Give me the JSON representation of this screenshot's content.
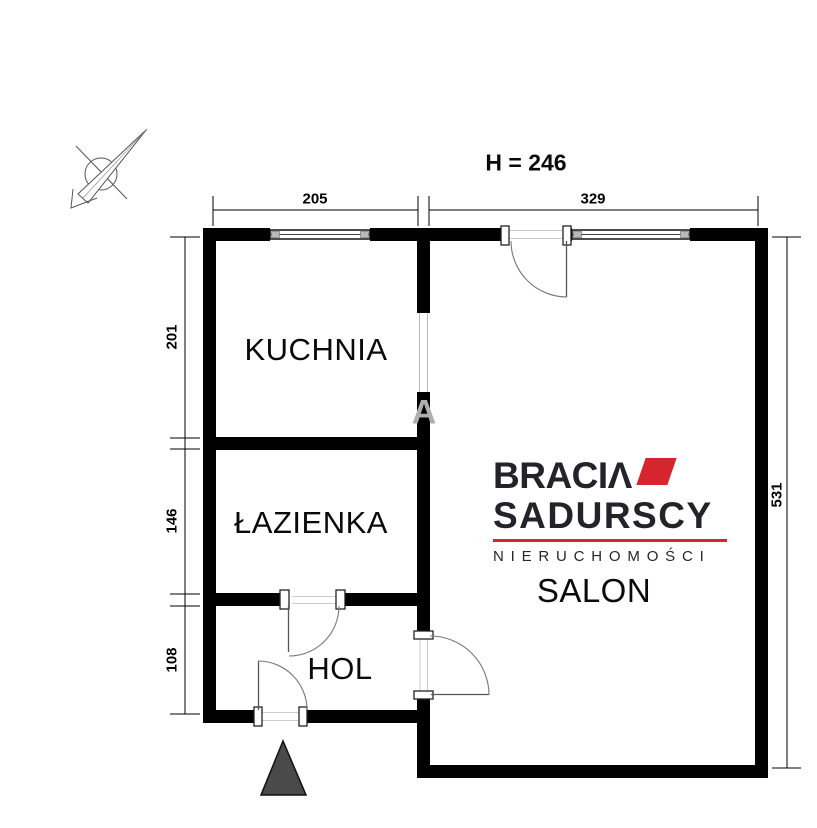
{
  "header": {
    "ceiling_height": "H = 246"
  },
  "dimensions": {
    "top": [
      {
        "label": "205"
      },
      {
        "label": "329"
      }
    ],
    "left": [
      {
        "label": "201"
      },
      {
        "label": "146"
      },
      {
        "label": "108"
      }
    ],
    "right": [
      {
        "label": "531"
      }
    ]
  },
  "rooms": {
    "kitchen": {
      "label": "KUCHNIA"
    },
    "bathroom": {
      "label": "ŁAZIENKA"
    },
    "hall": {
      "label": "HOL"
    },
    "living_room": {
      "label": "SALON"
    }
  },
  "watermark_letter": "A",
  "logo": {
    "line1_main": "BRACI",
    "line1_last": "Λ",
    "line2": "SADURSCY",
    "line3": "NIERUCHOMOŚCI"
  },
  "colors": {
    "wall_black": "#000000",
    "accent_red": "#d6252e",
    "logo_dark": "#232329",
    "watermark_gray": "#aeaeae",
    "entrance_triangle_gray": "#4a4a4a"
  }
}
